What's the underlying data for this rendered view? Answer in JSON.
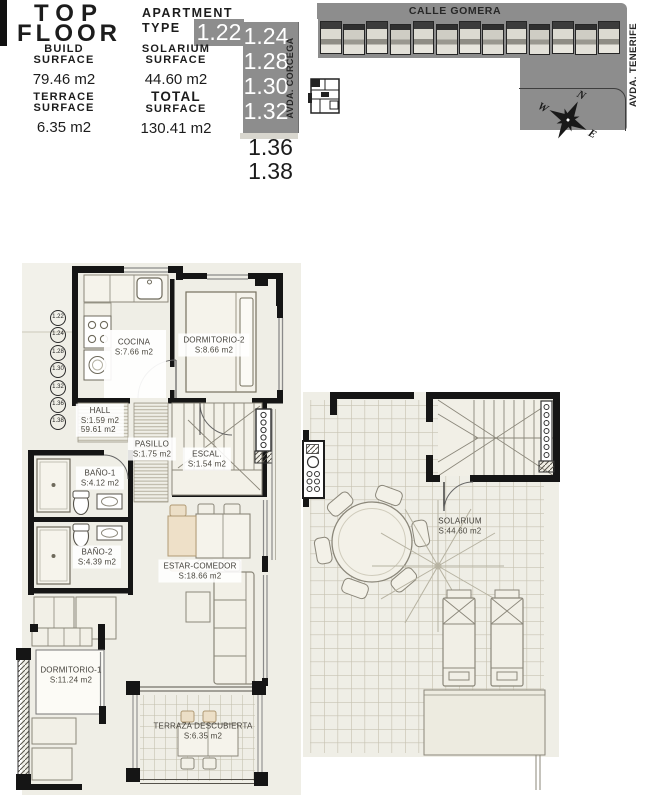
{
  "header": {
    "title_line1": "TOP",
    "title_line2": "FLOOR",
    "apartment_type_line1": "APARTMENT",
    "apartment_type_line2": "TYPE",
    "types_highlighted": [
      "1.22",
      "1.24",
      "1.28",
      "1.30",
      "1.32"
    ],
    "types_plain": [
      "1.36",
      "1.38"
    ],
    "street_vertical": "AVDA. CORCEGA",
    "stats": [
      {
        "label_line1": "BUILD",
        "label_line2": "SURFACE",
        "value": "79.46 m2"
      },
      {
        "label_line1": "SOLARIUM",
        "label_line2": "SURFACE",
        "value": "44.60 m2"
      },
      {
        "label_line1": "TERRACE",
        "label_line2": "SURFACE",
        "value": "6.35 m2"
      },
      {
        "label_line1": "TOTAL",
        "label_line2": "SURFACE",
        "value": "130.41 m2"
      }
    ]
  },
  "site_plan": {
    "street_top": "CALLE GOMERA",
    "street_right": "AVDA. TENERIFE",
    "compass_n": "N",
    "compass_e": "E",
    "compass_w": "W"
  },
  "main_plan": {
    "unit_badges": [
      "1.22",
      "1.24",
      "1.28",
      "1.30",
      "1.32",
      "1.36",
      "1.38"
    ],
    "rooms": [
      {
        "name": "COCINA",
        "area": "S:7.66 m2"
      },
      {
        "name": "DORMITORIO-2",
        "area": "S:8.66 m2"
      },
      {
        "name": "HALL",
        "area": "S:1.59 m2",
        "extra": "59.61 m2"
      },
      {
        "name": "PASILLO",
        "area": "S:1.75 m2"
      },
      {
        "name": "ESCAL.",
        "area": "S:1.54 m2"
      },
      {
        "name": "BAÑO-1",
        "area": "S:4.12 m2"
      },
      {
        "name": "BAÑO-2",
        "area": "S:4.39 m2"
      },
      {
        "name": "ESTAR-COMEDOR",
        "area": "S:18.66 m2"
      },
      {
        "name": "DORMITORIO-1",
        "area": "S:11.24 m2"
      },
      {
        "name": "TERRAZA DESCUBIERTA",
        "area": "S:6.35 m2"
      }
    ]
  },
  "solarium_plan": {
    "room_name": "SOLARIUM",
    "room_area": "S:44.60 m2"
  },
  "colors": {
    "site_gray": "#8d8d8d",
    "paper_beige": "#efeee6",
    "wall_black": "#151515",
    "tan_furniture": "#eee0c8"
  }
}
